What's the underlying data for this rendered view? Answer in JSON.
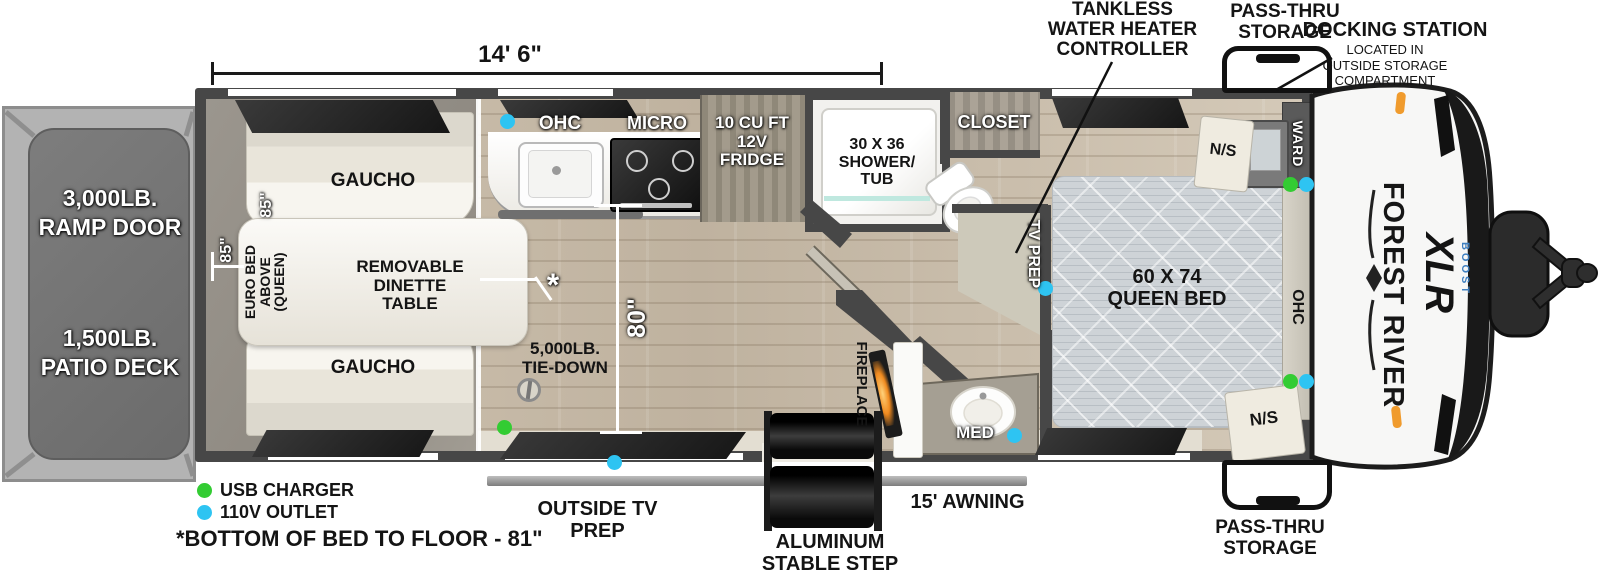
{
  "rear": {
    "ramp_door": "3,000LB.\nRAMP DOOR",
    "patio_deck": "1,500LB.\nPATIO DECK"
  },
  "garage": {
    "gaucho_top": "GAUCHO",
    "gaucho_bottom": "GAUCHO",
    "euro_bed": "EURO BED\nABOVE\n(QUEEN)",
    "dinette": "REMOVABLE\nDINETTE\nTABLE",
    "tie_down": "5,000LB.\nTIE-DOWN",
    "asterisk": "*"
  },
  "kitchen": {
    "ohc": "OHC",
    "micro": "MICRO",
    "fridge": "10 CU FT\n12V\nFRIDGE"
  },
  "bath": {
    "shower": "30 X 36\nSHOWER/\nTUB",
    "med": "MED"
  },
  "living": {
    "fireplace": "FIREPLACE"
  },
  "bedroom": {
    "closet": "CLOSET",
    "tv_prep": "TV PREP",
    "queen_bed": "60 X 74\nQUEEN BED",
    "ohc": "OHC",
    "ward": "WARD",
    "ns_top": "N/S",
    "ns_bottom": "N/S"
  },
  "callouts": {
    "tankless": "TANKLESS\nWATER HEATER\nCONTROLLER",
    "pass_thru_top": "PASS-THRU\nSTORAGE",
    "pass_thru_bottom": "PASS-THRU\nSTORAGE",
    "docking_title": "DOCKING STATION",
    "docking_sub": "LOCATED IN\nOUTSIDE STORAGE\nCOMPARTMENT",
    "outside_tv": "OUTSIDE TV\nPREP",
    "awning": "15' AWNING",
    "step": "ALUMINUM\nSTABLE STEP"
  },
  "dimensions": {
    "garage_length": "14' 6\"",
    "garage_width": "85\"",
    "bed_length": "85\"",
    "interior_width": "80\""
  },
  "legend": {
    "usb_label": "USB CHARGER",
    "usb_color": "#33cc33",
    "outlet_label": "110V OUTLET",
    "outlet_color": "#2ec4f2",
    "footnote": "*BOTTOM OF BED TO FLOOR - 81\""
  },
  "branding": {
    "make": "FOREST RIVER",
    "model": "XLR",
    "series": "BOOST"
  },
  "colors": {
    "wall": "#474747",
    "wood_floor": "#c9bcab",
    "garage_floor": "#97928a",
    "deck": "#747474",
    "fire_glow": "#f08a1f"
  }
}
